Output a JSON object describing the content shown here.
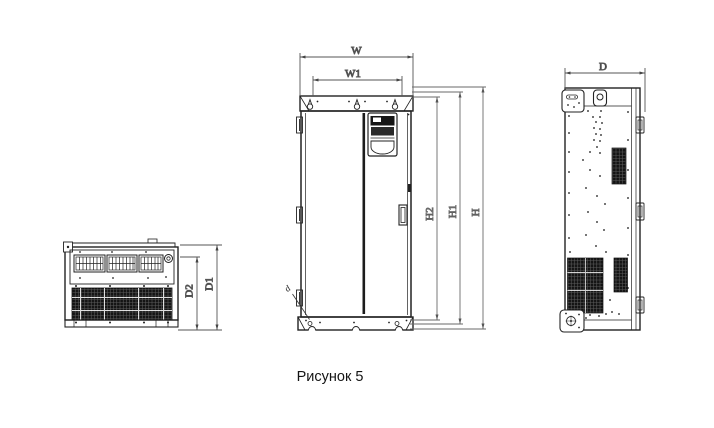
{
  "caption": "Рисунок 5",
  "dim_labels": {
    "W": "W",
    "W1": "W1",
    "H": "H",
    "H1": "H1",
    "H2": "H2",
    "D": "D",
    "D1": "D1",
    "D2": "D2",
    "d": "d"
  },
  "colors": {
    "background": "#ffffff",
    "drawing_line": "#222222",
    "dimension_line": "#555555",
    "text": "#1a1a1a"
  }
}
